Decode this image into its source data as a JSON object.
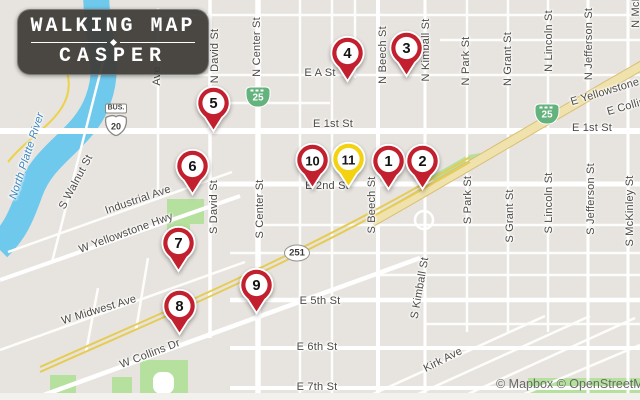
{
  "logo": {
    "line1": "WALKING MAP",
    "line2": "CASPER"
  },
  "attribution": {
    "text": "© Mapbox © OpenStreetMap"
  },
  "colors": {
    "land": "#e7e4df",
    "road": "#ffffff",
    "water": "#6fc9ed",
    "park": "#b5e09e",
    "highway_fill": "#f0e2ad",
    "highway_casing": "#d9bf74",
    "rail": "#e6cc55",
    "pin_red": "#c2202e",
    "pin_yellow": "#f3d211",
    "shield_green": "#64b27d",
    "logo_bg": "#3d3b37"
  },
  "pins": [
    {
      "label": "1",
      "x": 388,
      "y": 160,
      "color": "red"
    },
    {
      "label": "2",
      "x": 422,
      "y": 160,
      "color": "red"
    },
    {
      "label": "3",
      "x": 406,
      "y": 47,
      "color": "red"
    },
    {
      "label": "4",
      "x": 347,
      "y": 52,
      "color": "red"
    },
    {
      "label": "5",
      "x": 213,
      "y": 102,
      "color": "red"
    },
    {
      "label": "6",
      "x": 192,
      "y": 165,
      "color": "red"
    },
    {
      "label": "7",
      "x": 178,
      "y": 242,
      "color": "red"
    },
    {
      "label": "8",
      "x": 179,
      "y": 305,
      "color": "red"
    },
    {
      "label": "9",
      "x": 256,
      "y": 284,
      "color": "red"
    },
    {
      "label": "10",
      "x": 312,
      "y": 159,
      "color": "red"
    },
    {
      "label": "11",
      "x": 348,
      "y": 158,
      "color": "yellow"
    }
  ],
  "shields": [
    {
      "kind": "us_bus",
      "banner": "BUS.",
      "number": "20",
      "x": 116,
      "y": 120
    },
    {
      "kind": "interstate",
      "number": "25",
      "x": 258,
      "y": 97
    },
    {
      "kind": "interstate",
      "number": "25",
      "x": 547,
      "y": 114
    },
    {
      "kind": "oval",
      "number": "251",
      "x": 297,
      "y": 253
    }
  ],
  "street_labels": [
    {
      "text": "E A St",
      "x": 320,
      "y": 73,
      "rot": 0
    },
    {
      "text": "E 1st St",
      "x": 333,
      "y": 124,
      "rot": 0
    },
    {
      "text": "E 1st St",
      "x": 592,
      "y": 128,
      "rot": 0
    },
    {
      "text": "E 2nd St",
      "x": 327,
      "y": 186,
      "rot": 0
    },
    {
      "text": "E 5th St",
      "x": 320,
      "y": 301,
      "rot": 0
    },
    {
      "text": "E 6th St",
      "x": 317,
      "y": 347,
      "rot": 0
    },
    {
      "text": "E 7th St",
      "x": 317,
      "y": 387,
      "rot": 0
    },
    {
      "text": "Kirk Ave",
      "x": 443,
      "y": 360,
      "rot": -27
    },
    {
      "text": "W Collins Dr",
      "x": 150,
      "y": 354,
      "rot": -21
    },
    {
      "text": "W Midwest Ave",
      "x": 99,
      "y": 310,
      "rot": -17
    },
    {
      "text": "W Yellowstone Hwy",
      "x": 126,
      "y": 233,
      "rot": -20
    },
    {
      "text": "Industrial Ave",
      "x": 138,
      "y": 200,
      "rot": -19
    },
    {
      "text": "E Yellowstone",
      "x": 605,
      "y": 92,
      "rot": -17
    },
    {
      "text": "E Collins",
      "x": 629,
      "y": 106,
      "rot": -16
    },
    {
      "text": "North Platte River",
      "x": 27,
      "y": 156,
      "rot": -72,
      "kind": "water"
    },
    {
      "text": "S Walnut St",
      "x": 76,
      "y": 182,
      "rot": -62
    },
    {
      "text": "Ave",
      "x": 157,
      "y": 76,
      "rot": -90
    },
    {
      "text": "N David St",
      "x": 215,
      "y": 56,
      "rot": -90
    },
    {
      "text": "S David St",
      "x": 214,
      "y": 207,
      "rot": -90
    },
    {
      "text": "N Center St",
      "x": 257,
      "y": 47,
      "rot": -90
    },
    {
      "text": "S Center St",
      "x": 260,
      "y": 209,
      "rot": -90
    },
    {
      "text": "N Beech St",
      "x": 383,
      "y": 55,
      "rot": -90
    },
    {
      "text": "S Beech St",
      "x": 372,
      "y": 205,
      "rot": -90
    },
    {
      "text": "N Kimball St",
      "x": 426,
      "y": 50,
      "rot": -90
    },
    {
      "text": "S Kimball St",
      "x": 420,
      "y": 288,
      "rot": -80
    },
    {
      "text": "N Park St",
      "x": 466,
      "y": 61,
      "rot": -90
    },
    {
      "text": "S Park St",
      "x": 468,
      "y": 200,
      "rot": -90
    },
    {
      "text": "N Grant St",
      "x": 508,
      "y": 59,
      "rot": -90
    },
    {
      "text": "S Grant St",
      "x": 510,
      "y": 216,
      "rot": -90
    },
    {
      "text": "N Lincoln St",
      "x": 549,
      "y": 41,
      "rot": -90
    },
    {
      "text": "S Lincoln St",
      "x": 549,
      "y": 203,
      "rot": -90
    },
    {
      "text": "N Jefferson St",
      "x": 589,
      "y": 44,
      "rot": -90
    },
    {
      "text": "S Jefferson St",
      "x": 591,
      "y": 199,
      "rot": -90
    },
    {
      "text": "N McKinley St",
      "x": 636,
      "y": -8,
      "rot": -90
    },
    {
      "text": "S McKinley St",
      "x": 630,
      "y": 211,
      "rot": -90
    }
  ]
}
